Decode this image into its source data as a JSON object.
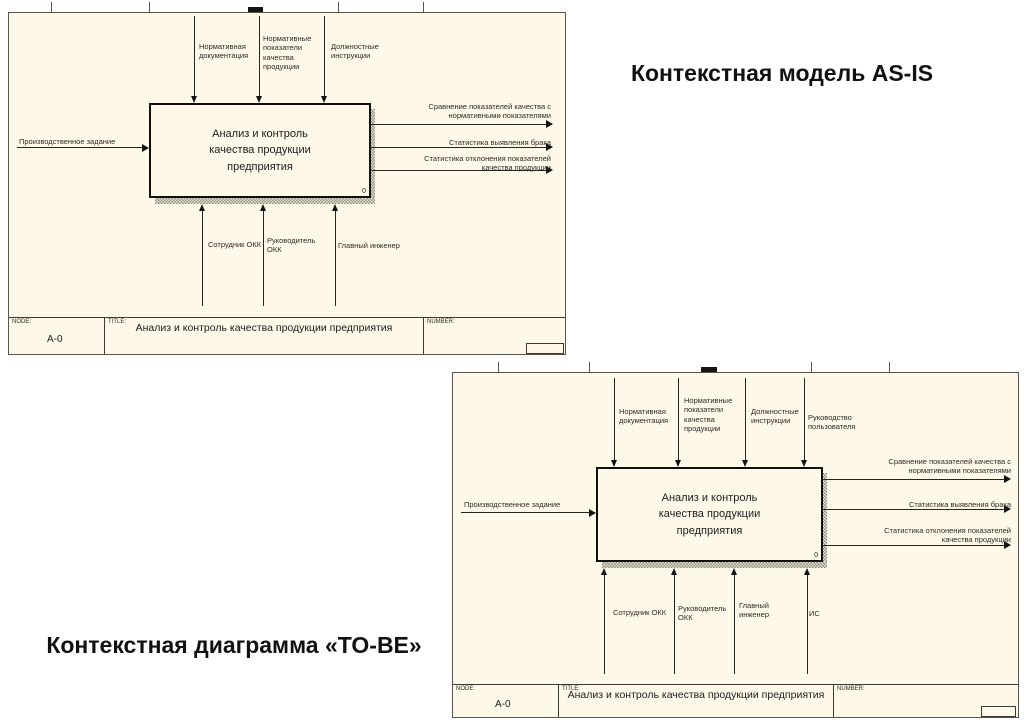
{
  "headings": {
    "asis": "Контекстная модель AS-IS",
    "tobe": "Контекстная диаграмма «TO-BE»"
  },
  "colors": {
    "sheet_bg": "#fdf8e8",
    "line": "#26261f",
    "shadow": "#8f8c82",
    "heading_text": "#111111"
  },
  "asis": {
    "controls": [
      "Нормативная\nдокументация",
      "Нормативные\nпоказатели\nкачества\nпродукции",
      "Должностные\nинструкции"
    ],
    "input": "Производственное задание",
    "outputs": [
      "Сравнение показателей качества с\nнормативными показателями",
      "Статистика выявления брака",
      "Статистика отклонения показателей\nкачества продукции"
    ],
    "mechanisms": [
      "Сотрудник ОКК",
      "Руководитель\nОКК",
      "Главный инженер"
    ],
    "box": {
      "label": "Анализ и контроль\nкачества продукции\nпредприятия",
      "number": "0"
    },
    "footer": {
      "node_label": "NODE:",
      "node": "A-0",
      "title_label": "TITLE:",
      "title": "Анализ и контроль качества продукции  предприятия",
      "number_label": "NUMBER:"
    }
  },
  "tobe": {
    "controls": [
      "Нормативная\nдокументация",
      "Нормативные\nпоказатели\nкачества\nпродукции",
      "Должностные\nинструкции",
      "Руководство\nпользователя"
    ],
    "input": "Производственное задание",
    "outputs": [
      "Сравнение показателей качества с\nнормативными показателями",
      "Статистика выявления брака",
      "Статистика отклонения показателей\nкачества продукции"
    ],
    "mechanisms": [
      "Сотрудник ОКК",
      "Руководитель\nОКК",
      "Главный\nинженер",
      "ИС"
    ],
    "box": {
      "label": "Анализ и контроль\nкачества продукции\nпредприятия",
      "number": "0"
    },
    "footer": {
      "node_label": "NODE:",
      "node": "A-0",
      "title_label": "TITLE:",
      "title": "Анализ и контроль качества продукции  предприятия",
      "number_label": "NUMBER:"
    }
  }
}
